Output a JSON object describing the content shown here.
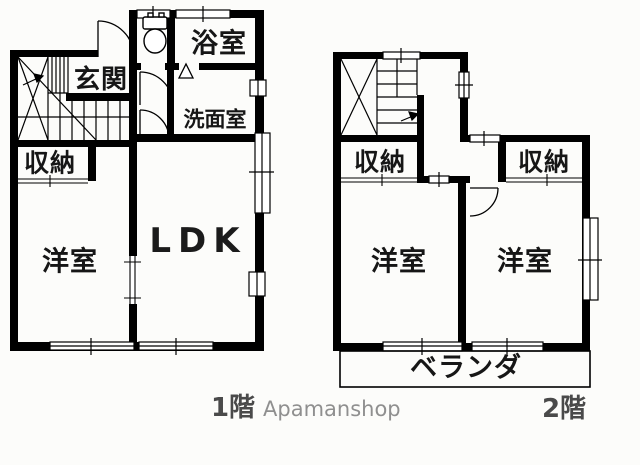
{
  "canvas": {
    "background": "#fcfcfa",
    "wall_color": "#000000",
    "label_color": "#161616",
    "caption_color": "#4a4a4a",
    "watermark_color": "#8f8f8f"
  },
  "floor1": {
    "caption": "1階",
    "labels": {
      "entrance": "玄関",
      "bathroom": "浴室",
      "washroom": "洗面室",
      "storage": "収納",
      "bedroom": "洋室",
      "ldk": "LDK"
    }
  },
  "floor2": {
    "caption": "2階",
    "labels": {
      "storage_left": "収納",
      "storage_right": "収納",
      "bedroom_left": "洋室",
      "bedroom_right": "洋室",
      "veranda": "ベランダ"
    }
  },
  "watermark": "Apamanshop"
}
